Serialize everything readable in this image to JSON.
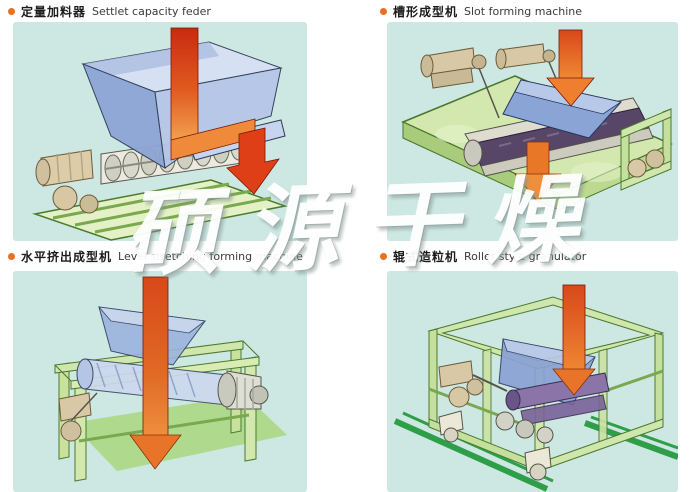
{
  "page": {
    "watermark": "硕源干燥",
    "background": "#ffffff"
  },
  "palette": {
    "panel_cyan": "#cde7e2",
    "bullet_orange": "#e8701f",
    "label_zh_color": "#1c1c1c",
    "label_en_color": "#3a3a3a",
    "arrow_red": "#c92a10",
    "arrow_orange": "#f2a04e",
    "hopper_blue": "#9db4de",
    "frame_green_light": "#cfe6ac",
    "frame_green_dark": "#4a7a2e",
    "rail_green": "#2f9e48",
    "motor_tan": "#d9c8a6",
    "belt_purple": "#584668"
  },
  "sections": [
    {
      "id": "settlet-capacity-feeder",
      "label_zh": "定量加料器",
      "label_en": "Settlet capacity feder"
    },
    {
      "id": "slot-forming-machine",
      "label_zh": "槽形成型机",
      "label_en": "Slot forming machine"
    },
    {
      "id": "level-stretching-forming-machine",
      "label_zh": "水平挤出成型机",
      "label_en": "Level stretching forming machine"
    },
    {
      "id": "roller-style-granulator",
      "label_zh": "辊式造粒机",
      "label_en": "Roller style granulator"
    }
  ]
}
